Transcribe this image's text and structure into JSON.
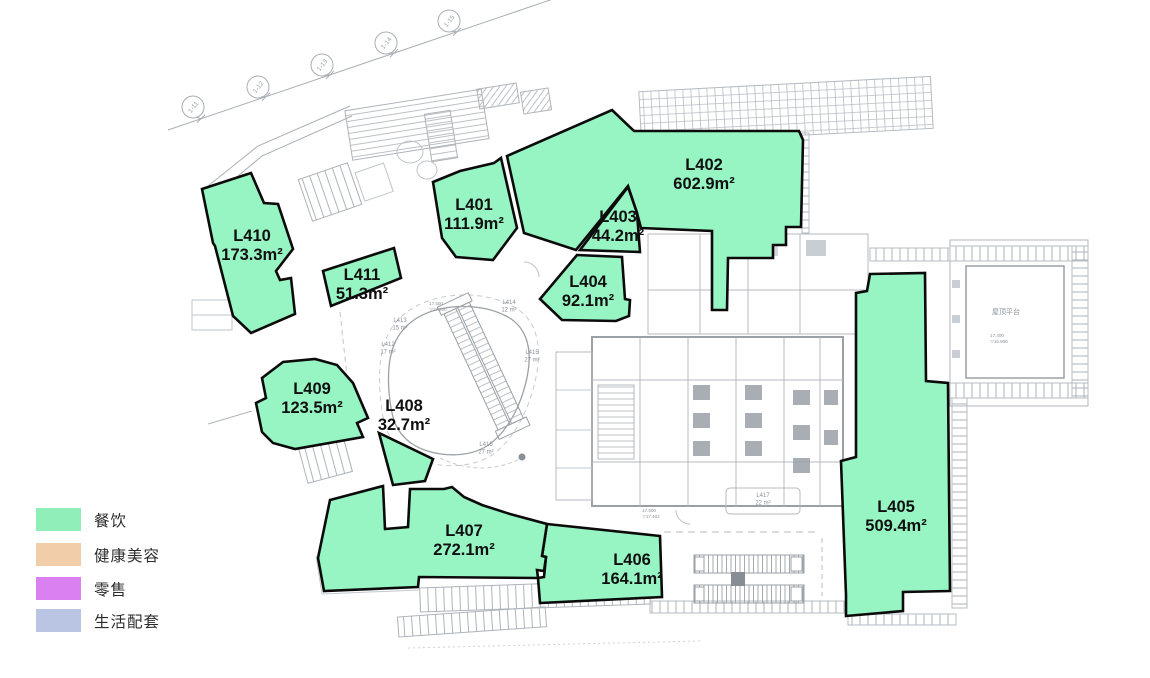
{
  "page": {
    "background": "#ffffff"
  },
  "legend": {
    "items": [
      {
        "label": "餐饮",
        "color": "#90EFB9"
      },
      {
        "label": "健康美容",
        "color": "#F2CDA9"
      },
      {
        "label": "零售",
        "color": "#DA80F1"
      },
      {
        "label": "生活配套",
        "color": "#B9C5E3"
      }
    ]
  },
  "plan": {
    "unit_fill": "#97F4C3",
    "outline_color": "#0b0b0b",
    "units": [
      {
        "id": "L401",
        "area_text": "111.9m²",
        "category": "餐饮",
        "label": {
          "x": 474,
          "y": 210
        },
        "points": "433,182 460,171 494,163 501,158 517,228 493,260 456,257 442,238"
      },
      {
        "id": "L402",
        "area_text": "602.9m²",
        "category": "餐饮",
        "label": {
          "x": 704,
          "y": 170
        },
        "points": "612,110 634,131 799,131 803,140 801,227 786,227 786,245 773,245 773,258 728,258 727,310 712,310 712,231 641,228 637,213 628,186 576,250 524,233 507,156"
      },
      {
        "id": "L403",
        "area_text": "44.2m²",
        "category": "餐饮",
        "label": {
          "x": 618,
          "y": 222
        },
        "points": "628,187 637,213 640,252 580,250"
      },
      {
        "id": "L404",
        "area_text": "92.1m²",
        "category": "餐饮",
        "label": {
          "x": 588,
          "y": 287
        },
        "points": "577,255 622,257 625,299 630,300 629,316 616,321 562,320 540,299"
      },
      {
        "id": "L405",
        "area_text": "509.4m²",
        "category": "餐饮",
        "label": {
          "x": 896,
          "y": 512
        },
        "points": "870,274 925,273 926,381 948,383 950,591 903,592 903,611 846,616 846,595 841,461 856,457 856,293 867,291"
      },
      {
        "id": "L406",
        "area_text": "164.1m²",
        "category": "餐饮",
        "label": {
          "x": 632,
          "y": 565
        },
        "points": "547,524 660,536 662,597 540,603 538,578 544,577 546,557 542,556"
      },
      {
        "id": "L407",
        "area_text": "272.1m²",
        "category": "餐饮",
        "label": {
          "x": 464,
          "y": 536
        },
        "points": "330,500 383,486 385,529 408,527 410,489 444,489 452,487 464,497 482,505 510,514 547,524 542,556 546,557 544,571 537,570 538,578 419,577 418,587 324,591 318,558"
      },
      {
        "id": "L408",
        "area_text": "32.7m²",
        "category": "餐饮",
        "label": {
          "x": 404,
          "y": 411
        },
        "points": "379,433 433,459 425,481 393,485"
      },
      {
        "id": "L409",
        "area_text": "123.5m²",
        "category": "餐饮",
        "label": {
          "x": 312,
          "y": 394
        },
        "points": "262,378 283,362 315,359 337,365 353,383 368,418 357,423 363,437 295,449 273,443 262,432 256,403 266,398"
      },
      {
        "id": "L410",
        "area_text": "173.3m²",
        "category": "餐饮",
        "label": {
          "x": 252,
          "y": 241
        },
        "points": "251,173 264,203 278,204 293,249 276,271 280,280 291,278 295,314 251,333 233,316 215,246 213,243 202,189"
      },
      {
        "id": "L411",
        "area_text": "51.3m²",
        "category": "餐饮",
        "label": {
          "x": 362,
          "y": 280
        },
        "points": "323,271 394,248 401,278 331,306"
      }
    ],
    "minor_units": [
      {
        "id": "L412",
        "area": "17 m²",
        "x": 388,
        "y": 346
      },
      {
        "id": "L413",
        "area": "15 m²",
        "x": 400,
        "y": 322
      },
      {
        "id": "L414",
        "area": "12 m²",
        "x": 509,
        "y": 304
      },
      {
        "id": "L415",
        "area": "27 m²",
        "x": 532,
        "y": 354
      },
      {
        "id": "L416",
        "area": "27 m²",
        "x": 486,
        "y": 446
      },
      {
        "id": "L417",
        "area": "22 m²",
        "x": 763,
        "y": 497
      }
    ],
    "grid_bubbles": [
      {
        "label": "1-11",
        "x": 193,
        "y": 107
      },
      {
        "label": "1-12",
        "x": 258,
        "y": 87
      },
      {
        "label": "1-13",
        "x": 322,
        "y": 65
      },
      {
        "label": "1-14",
        "x": 386,
        "y": 43
      },
      {
        "label": "1-15",
        "x": 449,
        "y": 21
      }
    ],
    "annotations": [
      {
        "text": "屋顶平台",
        "x": 1006,
        "y": 314,
        "fs": 7
      },
      {
        "text": "17.500",
        "x": 436,
        "y": 305,
        "fs": 4.5
      },
      {
        "text": "▽17.400",
        "x": 438,
        "y": 311,
        "fs": 4.5
      },
      {
        "text": "17.500",
        "x": 649,
        "y": 512,
        "fs": 4.5
      },
      {
        "text": "▽17.402",
        "x": 651,
        "y": 518,
        "fs": 4.5
      },
      {
        "text": "17.400",
        "x": 997,
        "y": 337,
        "fs": 4.5
      },
      {
        "text": "▽16.900",
        "x": 999,
        "y": 343,
        "fs": 4.5
      }
    ]
  }
}
